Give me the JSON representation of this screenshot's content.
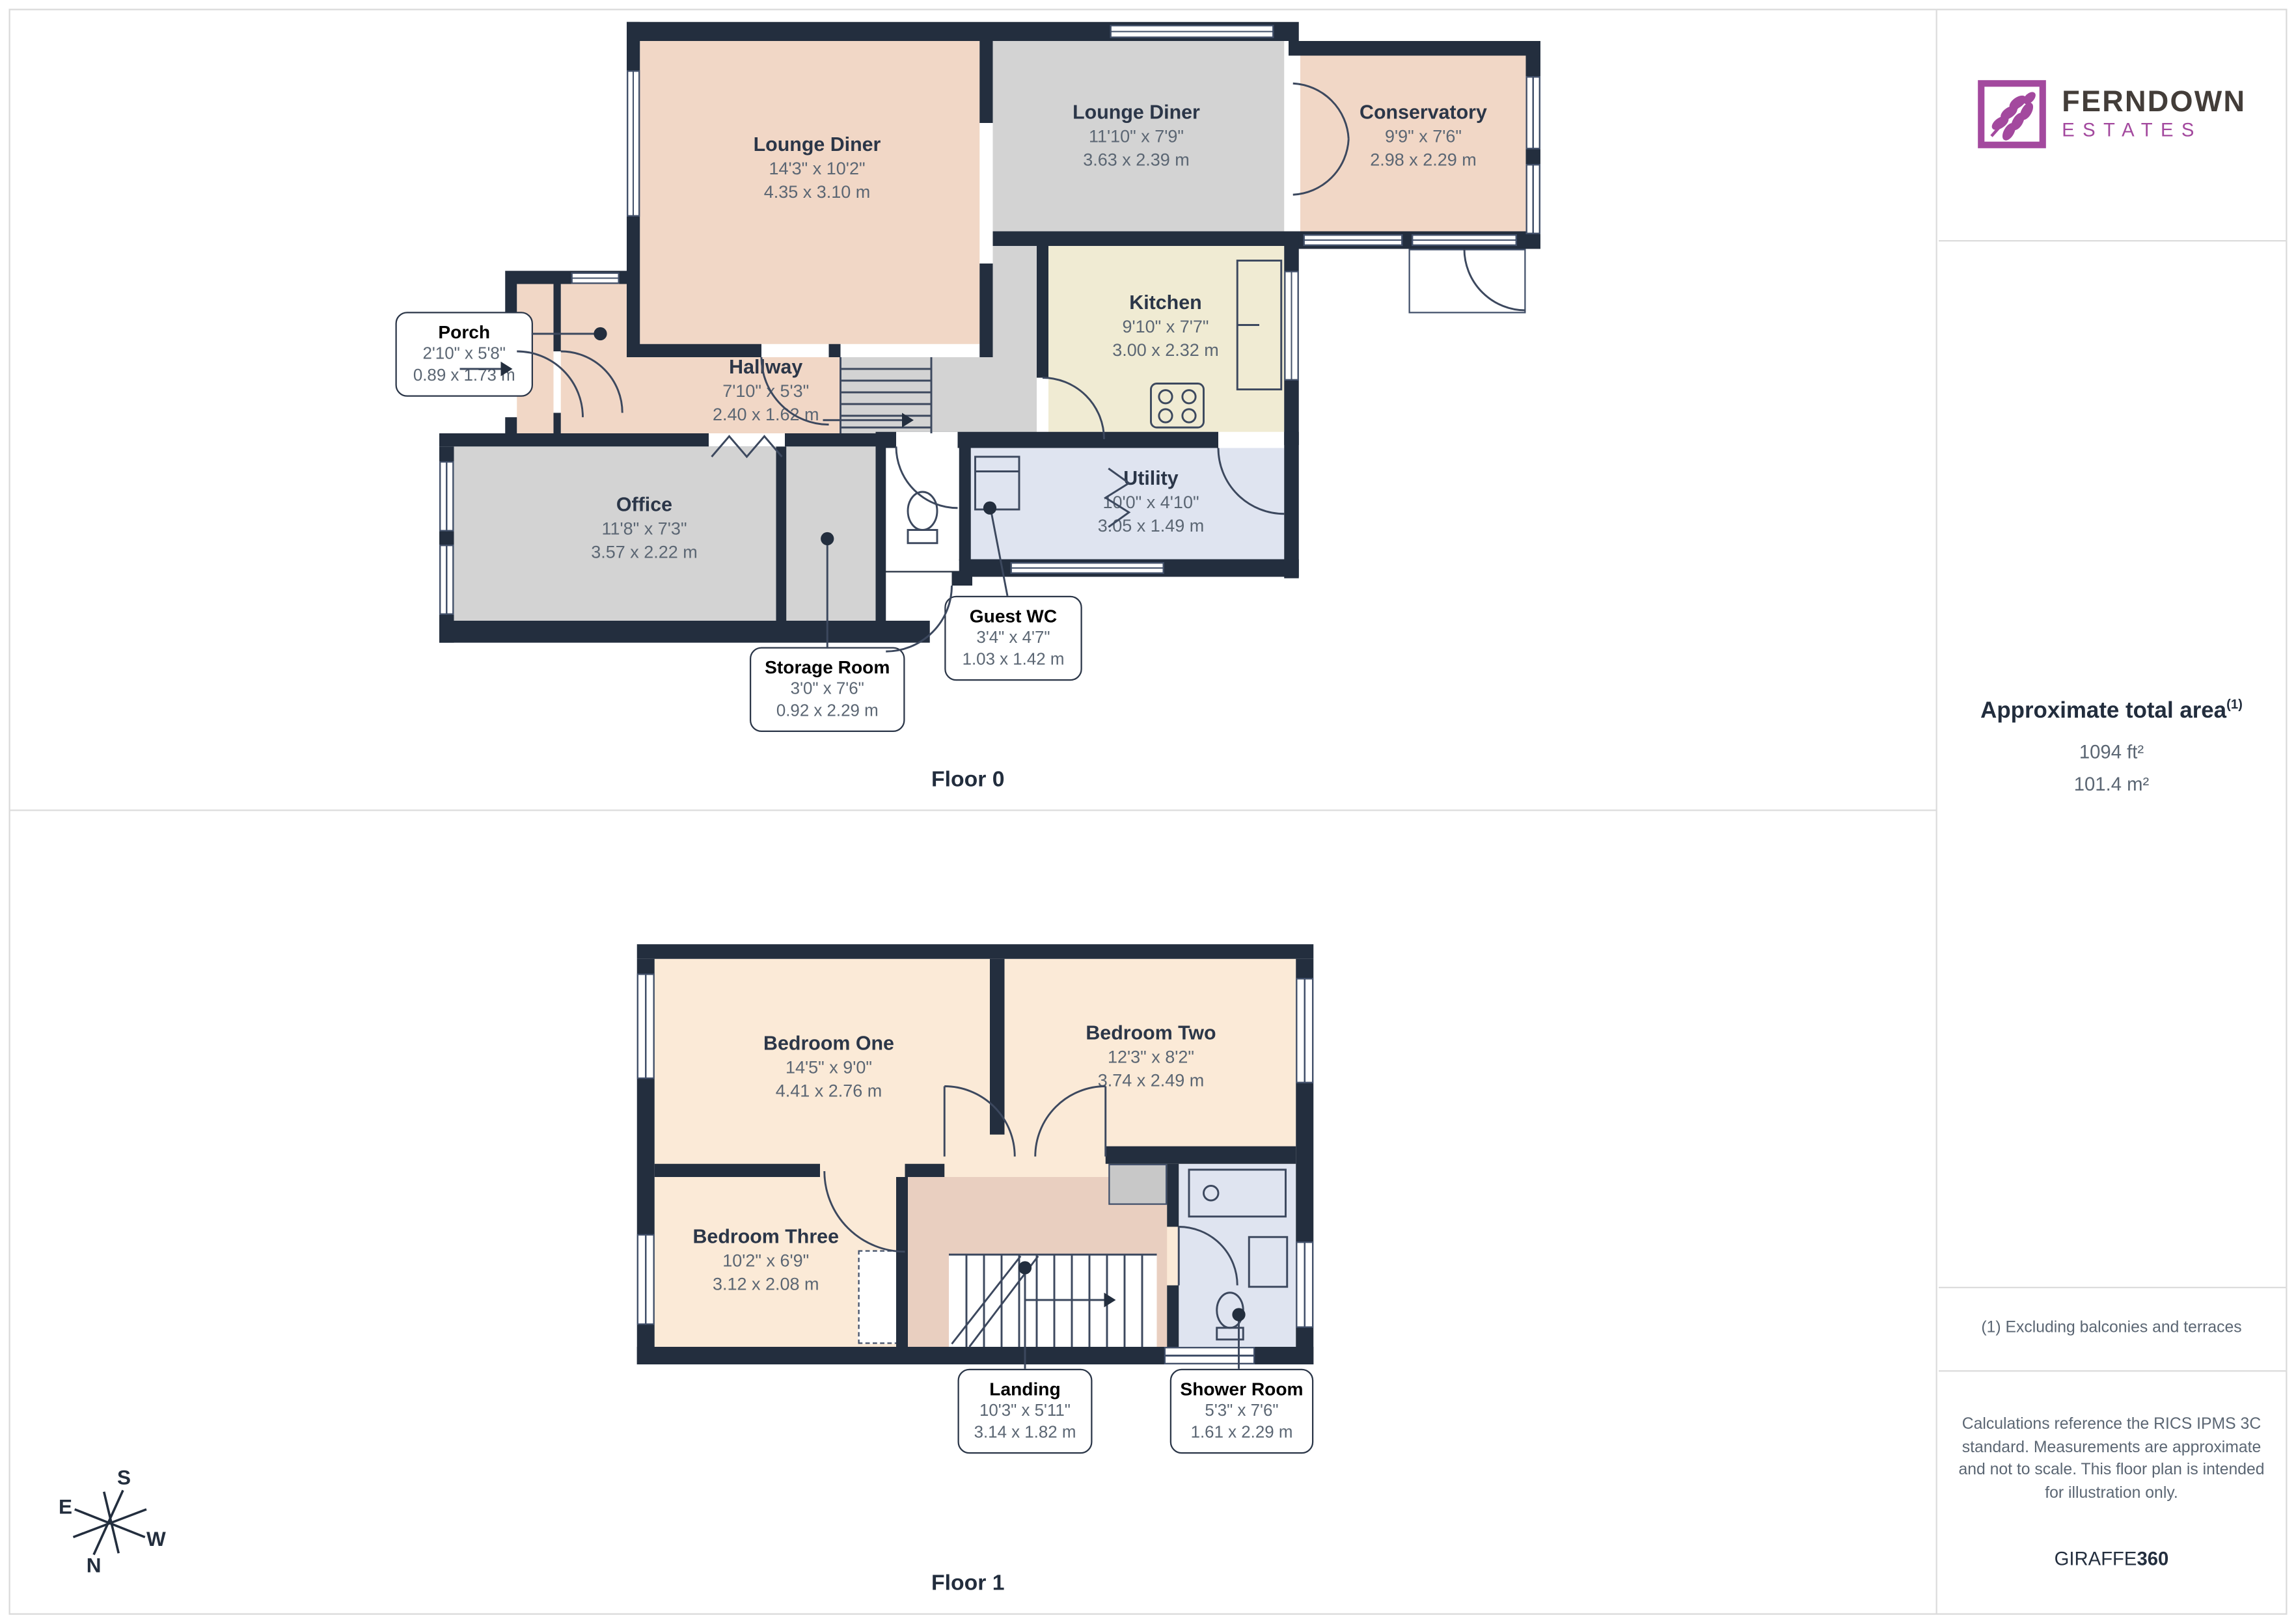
{
  "branding": {
    "primary": "FERNDOWN",
    "secondary": "ESTATES"
  },
  "sidebar": {
    "area_title": "Approximate total area",
    "area_note_marker": "(1)",
    "area_imperial": "1094 ft²",
    "area_metric": "101.4 m²",
    "footnote": "(1) Excluding balconies and terraces",
    "disclaimer": "Calculations reference the RICS IPMS 3C standard. Measurements are approximate and not to scale. This floor plan is intended for illustration only.",
    "credit_prefix": "GIRAFFE",
    "credit_suffix": "360"
  },
  "floor0": {
    "label": "Floor 0",
    "rooms": {
      "lounge1": {
        "name": "Lounge Diner",
        "imperial": "14'3\" x 10'2\"",
        "metric": "4.35 x 3.10 m"
      },
      "lounge2": {
        "name": "Lounge Diner",
        "imperial": "11'10\" x 7'9\"",
        "metric": "3.63 x 2.39 m"
      },
      "conservatory": {
        "name": "Conservatory",
        "imperial": "9'9\" x 7'6\"",
        "metric": "2.98 x 2.29 m"
      },
      "kitchen": {
        "name": "Kitchen",
        "imperial": "9'10\" x 7'7\"",
        "metric": "3.00 x 2.32 m"
      },
      "hallway": {
        "name": "Hallway",
        "imperial": "7'10\" x 5'3\"",
        "metric": "2.40 x 1.62 m"
      },
      "office": {
        "name": "Office",
        "imperial": "11'8\" x 7'3\"",
        "metric": "3.57 x 2.22 m"
      },
      "utility": {
        "name": "Utility",
        "imperial": "10'0\" x 4'10\"",
        "metric": "3.05 x 1.49 m"
      },
      "porch": {
        "name": "Porch",
        "imperial": "2'10\" x 5'8\"",
        "metric": "0.89 x 1.73 m"
      },
      "guest_wc": {
        "name": "Guest WC",
        "imperial": "3'4\" x 4'7\"",
        "metric": "1.03 x 1.42 m"
      },
      "storage": {
        "name": "Storage Room",
        "imperial": "3'0\" x 7'6\"",
        "metric": "0.92 x 2.29 m"
      }
    }
  },
  "floor1": {
    "label": "Floor 1",
    "rooms": {
      "bedroom1": {
        "name": "Bedroom One",
        "imperial": "14'5\" x 9'0\"",
        "metric": "4.41 x 2.76 m"
      },
      "bedroom2": {
        "name": "Bedroom Two",
        "imperial": "12'3\" x 8'2\"",
        "metric": "3.74 x 2.49 m"
      },
      "bedroom3": {
        "name": "Bedroom Three",
        "imperial": "10'2\" x 6'9\"",
        "metric": "3.12 x 2.08 m"
      },
      "landing": {
        "name": "Landing",
        "imperial": "10'3\" x 5'11\"",
        "metric": "3.14 x 1.82 m"
      },
      "shower": {
        "name": "Shower Room",
        "imperial": "5'3\" x 7'6\"",
        "metric": "1.61 x 2.29 m"
      }
    }
  },
  "compass": {
    "n": "N",
    "e": "E",
    "s": "S",
    "w": "W"
  },
  "colors": {
    "wall": "#232e3e",
    "peach": "#f1d7c6",
    "peach_light": "#fbead7",
    "landing": "#e9cfc0",
    "gray_room": "#d3d3d3",
    "cream": "#f0ebd3",
    "blue": "#dfe4f0",
    "brand_magenta": "#a3499e",
    "text_navy": "#2b3648",
    "text_gray": "#5b6673"
  }
}
